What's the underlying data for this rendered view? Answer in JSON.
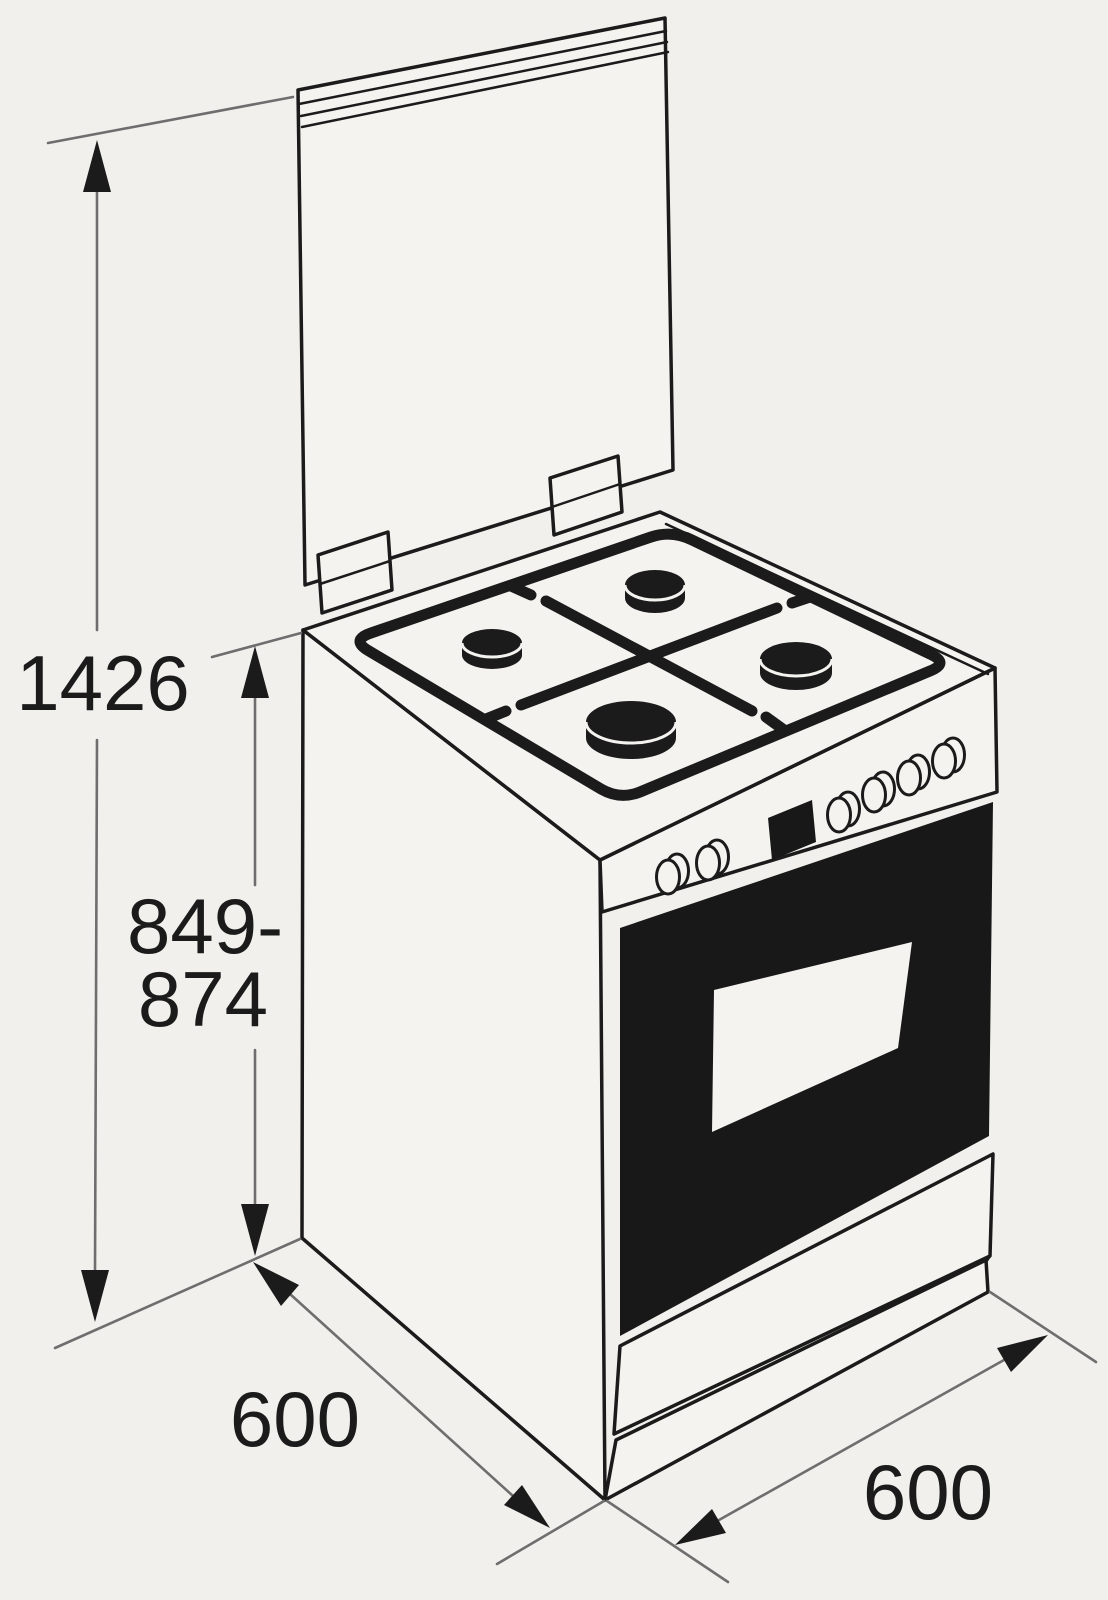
{
  "diagram": {
    "subject": "freestanding-cooker-dimension-drawing",
    "labels": {
      "total_height": "1426",
      "body_height_line1": "849-",
      "body_height_line2": "874",
      "depth": "600",
      "width": "600"
    },
    "colors": {
      "paper": "#f1f0ec",
      "ink": "#1b1b1b",
      "dimension_line": "#6e6e6e",
      "oven_door": "#181818"
    }
  }
}
